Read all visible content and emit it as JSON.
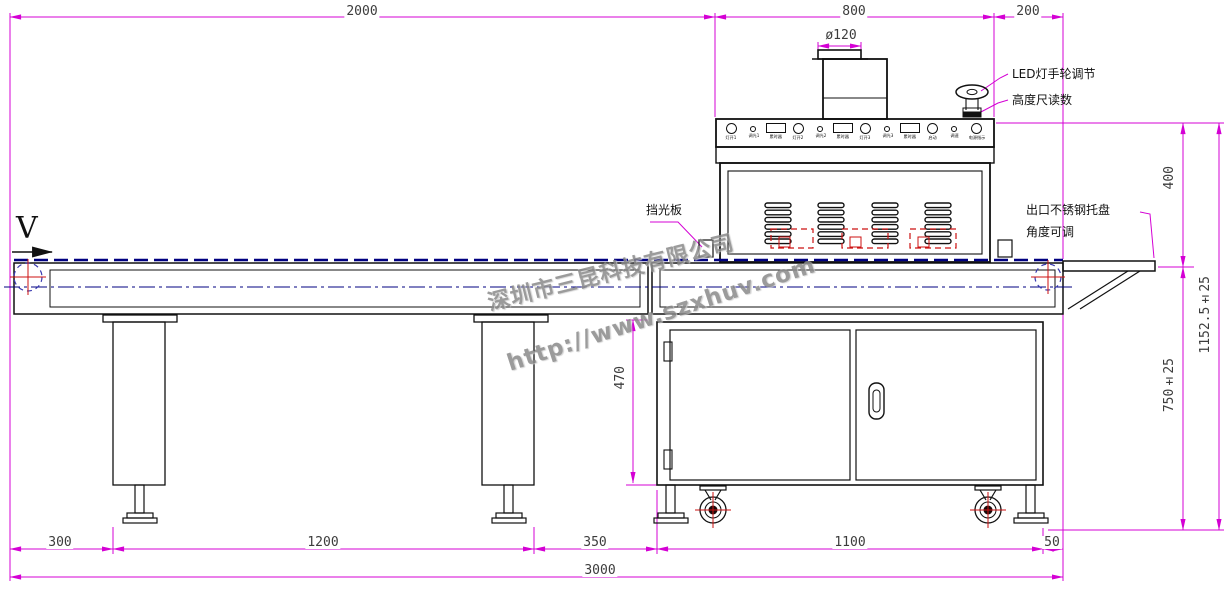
{
  "watermark": {
    "company": "深圳市三昆科技有限公司",
    "url": "http://www.szxhuv.com"
  },
  "flow": {
    "velocity_label": "V"
  },
  "annotations": {
    "duct_diameter": "ø120",
    "led_handwheel": "LED灯手轮调节",
    "height_scale": "高度尺读数",
    "light_baffle": "挡光板",
    "outlet_tray_line1": "出口不锈钢托盘",
    "outlet_tray_line2": "角度可调"
  },
  "dimensions": {
    "top": {
      "d2000": "2000",
      "d800": "800",
      "d200": "200"
    },
    "right": {
      "d400": "400",
      "d750": "750±25",
      "dtotal": "1152.5±25"
    },
    "stand": {
      "d470": "470"
    },
    "bottom": {
      "d300": "300",
      "d1200": "1200",
      "d350": "350",
      "d1100": "1100",
      "d50": "50",
      "d3000": "3000"
    }
  },
  "control_panel": {
    "items": [
      {
        "type": "circle",
        "label": "灯开1"
      },
      {
        "type": "dot",
        "label": "调光1"
      },
      {
        "type": "rect",
        "label": "累时器"
      },
      {
        "type": "circle",
        "label": "灯开2"
      },
      {
        "type": "dot",
        "label": "调光2"
      },
      {
        "type": "rect",
        "label": "累时器"
      },
      {
        "type": "circle",
        "label": "灯开3"
      },
      {
        "type": "dot",
        "label": "调光3"
      },
      {
        "type": "rect",
        "label": "累时器"
      },
      {
        "type": "circle",
        "label": "启动"
      },
      {
        "type": "dot",
        "label": "调速"
      },
      {
        "type": "circle",
        "label": "电源指示"
      }
    ]
  },
  "colors": {
    "dimension": "#d400d4",
    "conveyor": "#000080",
    "highlight": "#cc1111",
    "drawing": "#111111",
    "watermark": "#8a8a8a"
  }
}
